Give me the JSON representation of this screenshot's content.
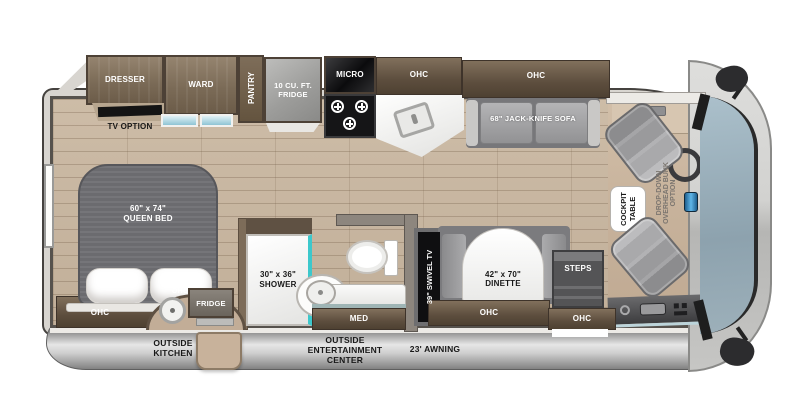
{
  "diagram_title": "RV floor plan",
  "labels": {
    "dresser": "DRESSER",
    "ward": "WARD",
    "pantry": "PANTRY",
    "tv_option": "TV OPTION",
    "fridge_10cuft": "10 CU. FT. FRIDGE",
    "micro": "MICRO",
    "ohc": "OHC",
    "sofa": "68\" JACK-KNIFE SOFA",
    "bed_size": "60\" x 74\"",
    "bed_name": "QUEEN BED",
    "shower_size": "30\" x 36\"",
    "shower_name": "SHOWER",
    "med": "MED",
    "swivel_tv": "39\" SWIVEL TV",
    "dinette_size": "42\" x 70\"",
    "dinette_name": "DINETTE",
    "steps": "STEPS",
    "cockpit_table_line1": "COCKPIT",
    "cockpit_table_line2": "TABLE",
    "bunk_line1": "DROP-DOWN",
    "bunk_line2": "OVERHEAD BUNK",
    "bunk_line3": "OPTION",
    "outside_fridge": "FRIDGE",
    "outside_kitchen": "OUTSIDE KITCHEN",
    "outside_entertainment": "OUTSIDE ENTERTAINMENT CENTER",
    "awning": "23' AWNING"
  },
  "colors": {
    "floor_wood": "#c8b7a2",
    "cockpit_floor": "#c7b29b",
    "cabinet_brown": "#7b6b57",
    "cabinet_dark_brown": "#5d4e3e",
    "appliance_gray": "#9b9b99",
    "sofa_gray": "#a9a9ab",
    "mattress_gray": "#6b6b6f",
    "teal_accent": "#3cc8cc",
    "windshield_blue": "#9db1bd",
    "body_shell_gray": "#d8d5d0",
    "awning_bar_gray": "#bdbdbd"
  }
}
